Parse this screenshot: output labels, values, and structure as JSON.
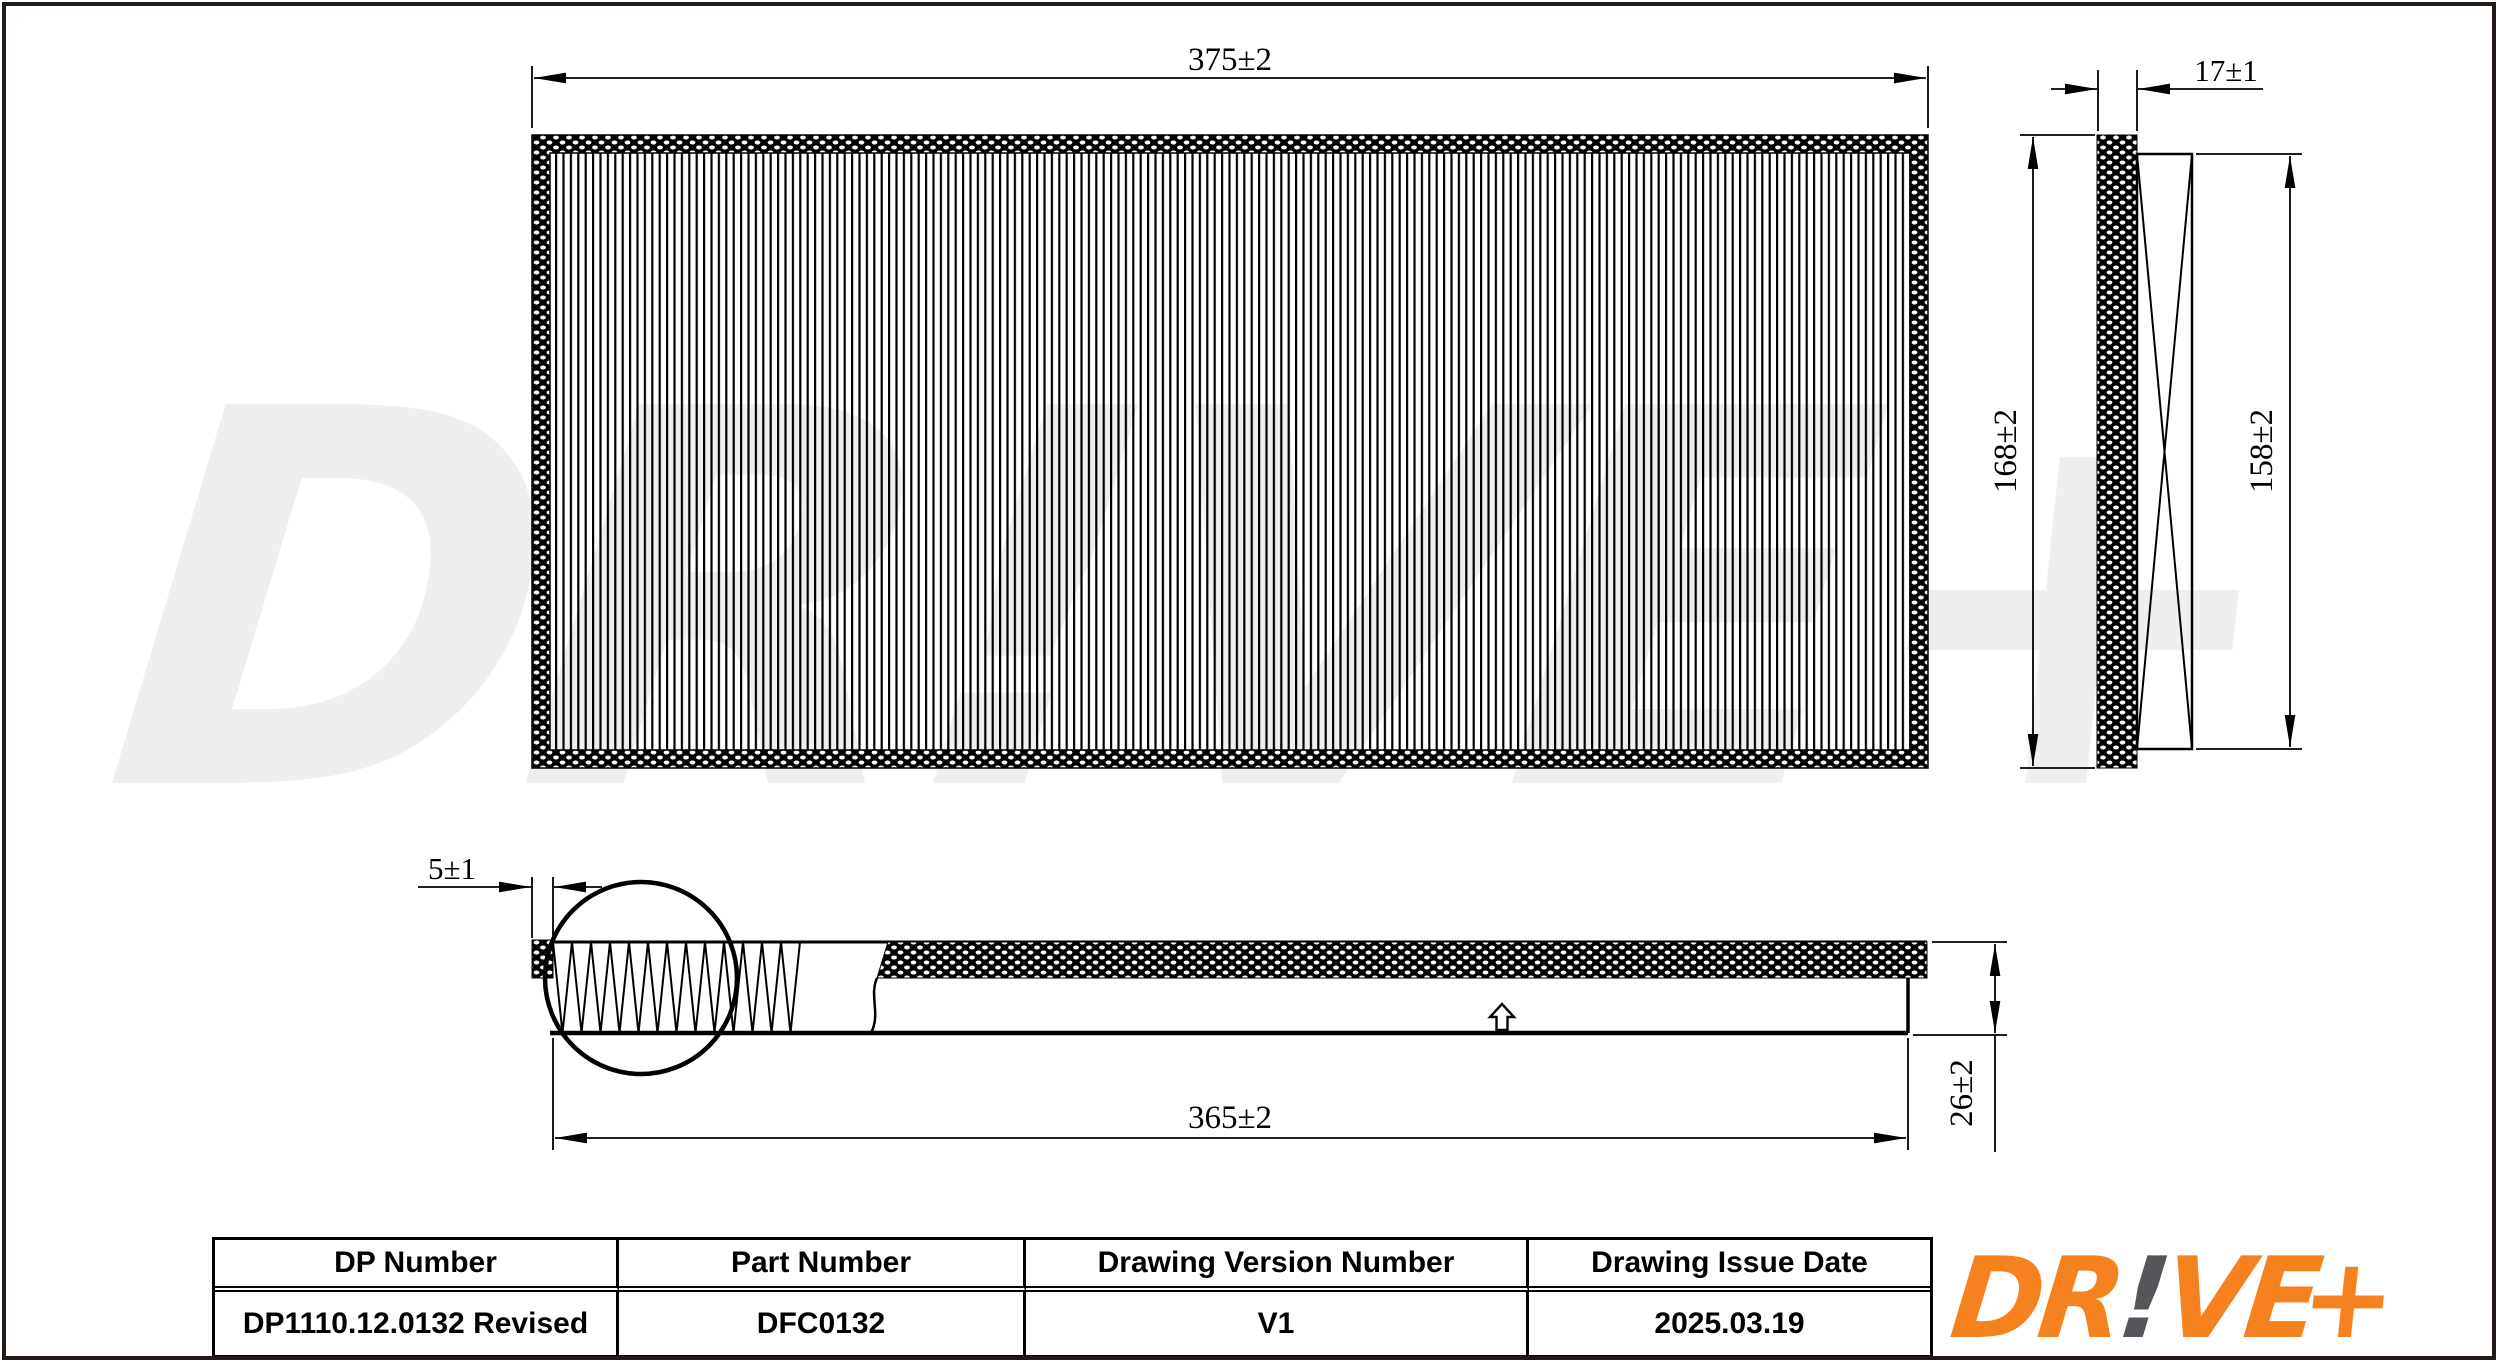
{
  "page": {
    "background": "#ffffff",
    "border_color": "#231a18"
  },
  "watermark": {
    "text": "DR!VE+",
    "color": "#efefef"
  },
  "drawing": {
    "description_names": {
      "top_view": "filter top view with pleats",
      "side_view": "filter side view with cross panel",
      "section_view": "filter profile section with pleat detail circle"
    },
    "flow_arrow_symbol": "⇧"
  },
  "dimensions": {
    "top_width": "375±2",
    "thickness": "17±1",
    "height_outer": "168±2",
    "height_inner": "158±2",
    "edge_offset": "5±1",
    "bottom_width": "365±2",
    "section_height": "26±2"
  },
  "table": {
    "headers": [
      "DP Number",
      "Part Number",
      "Drawing Version Number",
      "Drawing Issue Date"
    ],
    "values": [
      "DP1110.12.0132 Revised",
      "DFC0132",
      "V1",
      "2025.03.19"
    ]
  },
  "logo": {
    "part1": "DR",
    "bang": "!",
    "part2": "VE",
    "plus": "+",
    "orange": "#F5821F",
    "gray": "#55565A"
  }
}
